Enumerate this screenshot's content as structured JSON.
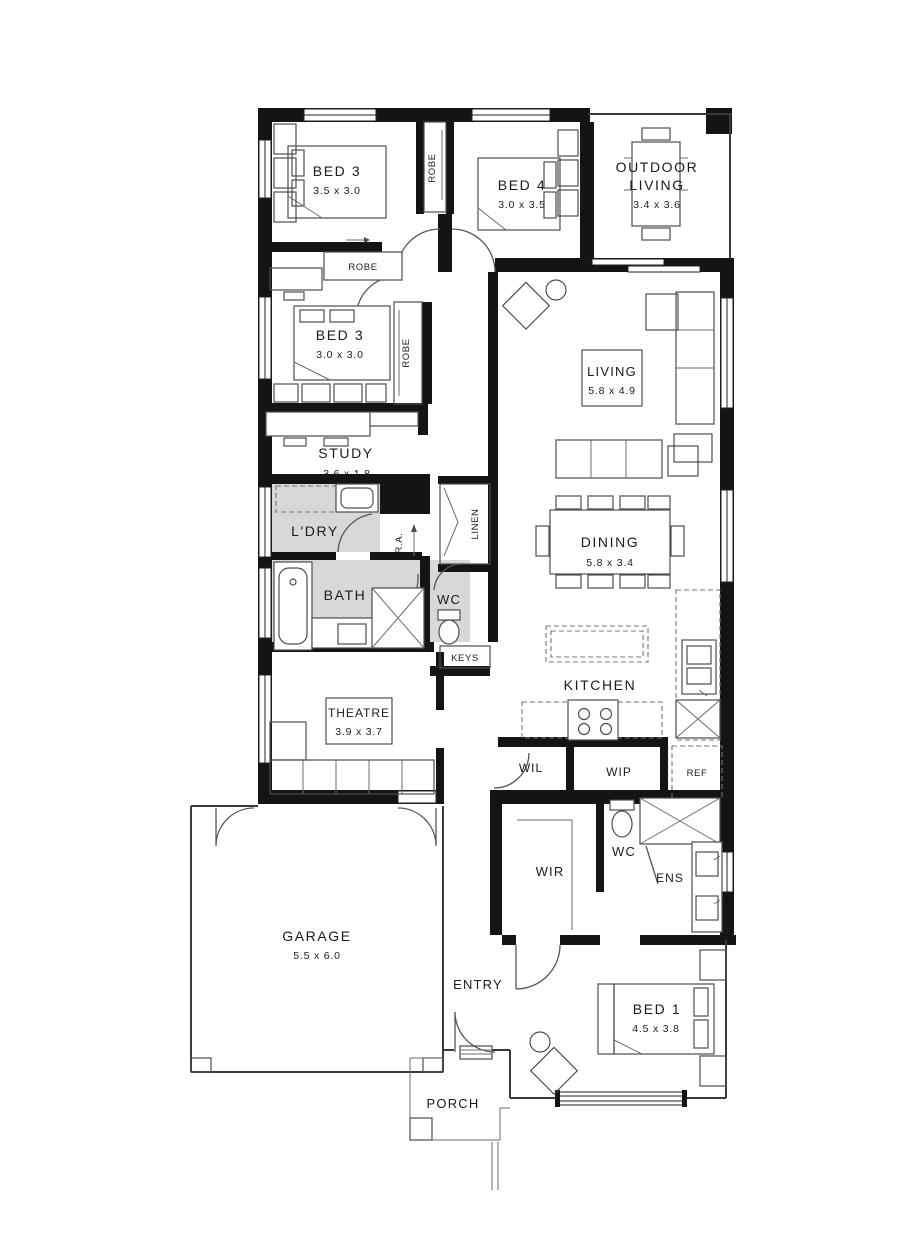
{
  "plan": {
    "rooms": {
      "bed3_top": {
        "name": "BED 3",
        "dims": "3.5 x 3.0"
      },
      "bed4": {
        "name": "BED 4",
        "dims": "3.0 x 3.5"
      },
      "outdoor_living": {
        "line1": "OUTDOOR",
        "line2": "LIVING",
        "dims": "3.4 x 3.6"
      },
      "bed3_mid": {
        "name": "BED 3",
        "dims": "3.0 x 3.0"
      },
      "study": {
        "name": "STUDY",
        "dims": "3.6 x 1.8"
      },
      "living": {
        "name": "LIVING",
        "dims": "5.8 x 4.9"
      },
      "laundry": {
        "name": "L'DRY"
      },
      "bath": {
        "name": "BATH"
      },
      "wc_main": {
        "name": "WC"
      },
      "dining": {
        "name": "DINING",
        "dims": "5.8 x 3.4"
      },
      "kitchen": {
        "name": "KITCHEN"
      },
      "theatre": {
        "name": "THEATRE",
        "dims": "3.9 x 3.7"
      },
      "wil": {
        "name": "WIL"
      },
      "wip": {
        "name": "WIP"
      },
      "wir": {
        "name": "WIR"
      },
      "wc_ens": {
        "name": "WC"
      },
      "ens": {
        "name": "ENS"
      },
      "garage": {
        "name": "GARAGE",
        "dims": "5.5 x 6.0"
      },
      "entry": {
        "name": "ENTRY"
      },
      "bed1": {
        "name": "BED 1",
        "dims": "4.5 x 3.8"
      },
      "porch": {
        "name": "PORCH"
      }
    },
    "fixtures": {
      "robes": [
        "ROBE",
        "ROBE",
        "ROBE"
      ],
      "linen": "LINEN",
      "keys": "KEYS",
      "ref": "REF",
      "return_air": "R.A."
    },
    "colors": {
      "wall": "#141414",
      "wet_floor": "#d8d8d8",
      "line": "#4d4d4d",
      "text": "#1b1b1b"
    }
  }
}
